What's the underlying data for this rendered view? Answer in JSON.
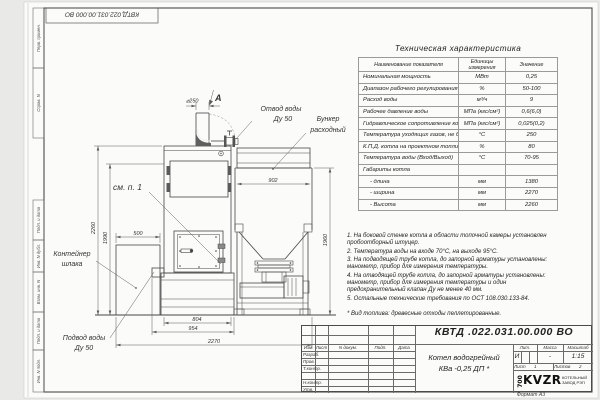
{
  "sheet": {
    "stamp_top": "КВТД.022.031.00.000 ВО",
    "format_label": "Формат А3",
    "side_labels": [
      "Перв. примен.",
      "Справ. N",
      "Подп. и дата",
      "Инв. N дубл.",
      "Взам. инв. N",
      "Подп. и дата",
      "Инв. N подл."
    ]
  },
  "spec_table": {
    "title": "Техническая характеристика",
    "headers": [
      "Наименование показателя",
      "Единицы измерения",
      "Значение"
    ],
    "rows": [
      [
        "Номинальная мощность",
        "МВт",
        "0,25"
      ],
      [
        "Диапазон рабочего регулирования",
        "%",
        "50-100"
      ],
      [
        "Расход воды",
        "м³/ч",
        "9"
      ],
      [
        "Рабочее давление воды",
        "МПа (кгс/см²)",
        "0,6(6,0)"
      ],
      [
        "Гидравлическое сопротивление котла",
        "МПа (кгс/см²)",
        "0,025(0,2)"
      ],
      [
        "Температура уходящих газов, не более",
        "°С",
        "250"
      ],
      [
        "К.П.Д. котла на проектном топливе",
        "%",
        "80"
      ],
      [
        "Температура воды (Вход/Выход)",
        "°С",
        "70-95"
      ],
      [
        "Габариты котла",
        "",
        ""
      ],
      [
        "- длина",
        "мм",
        "1380"
      ],
      [
        "- ширина",
        "мм",
        "2270"
      ],
      [
        "- Высота",
        "мм",
        "2260"
      ]
    ]
  },
  "notes": {
    "items": [
      "1. На боковой стенке котла в области топочной камеры установлен пробоотборный штуцер.",
      "2. Температура воды на входе 70°С, на выходе 95°С.",
      "3. На подводящей трубе котла, до запорной арматуры установлены: манометр, прибор для измерения температуры.",
      "4. На отводящей трубе котла, до запорной арматуры установлены: манометр, прибор для измерения температуры и один предохранительный клапан Ду не менее 40 мм.",
      "5. Остальные технические требования по ОСТ 108.030.133-84."
    ],
    "fuel": "* Вид топлива: древесные отходы пеллетированные."
  },
  "drawing": {
    "view_label": "А",
    "diameter": "⌀250",
    "labels": {
      "outlet1": "Отвод воды",
      "outlet2": "Ду 50",
      "hopper1": "Бункер",
      "hopper2": "расходный",
      "see": "см. п. 1",
      "slag1": "Контейнер",
      "slag2": "шлака",
      "inlet1": "Подвод воды",
      "inlet2": "Ду 50"
    },
    "dims": {
      "hopper_width": "902",
      "hopper_height": "1960",
      "total_height": "2260",
      "body_height": "1990",
      "slag_width": "500",
      "boiler_width": "804",
      "boiler_width2": "954",
      "total_width": "2270"
    }
  },
  "title_block": {
    "doc_number": "КВТД .022.031.00.000 ВО",
    "product_name1": "Котел водогрейный",
    "product_name2": "КВа -0,25  ДП *",
    "cols": {
      "izm": "Изм.",
      "list": "Лист",
      "docum": "N докум.",
      "podp": "Подп.",
      "data": "Дата"
    },
    "rows": {
      "razrab": "Разраб.",
      "prov": "Пров.",
      "tkontr": "Т.контр.",
      "nkontr": "Н.контр.",
      "utv": "Утв."
    },
    "lit_label": "Лит.",
    "lit_value": "И",
    "massa_label": "Масса",
    "massa_value": "-",
    "masshtab_label": "Масштаб",
    "masshtab_value": "1:15",
    "list_label": "Лист",
    "list_value": "1",
    "listov_label": "Листов",
    "listov_value": "2",
    "logo_num": "700",
    "logo_text": "KVZR",
    "logo_sub1": "КОТЕЛЬНЫЙ",
    "logo_sub2": "ЗАВОД РЭП"
  }
}
